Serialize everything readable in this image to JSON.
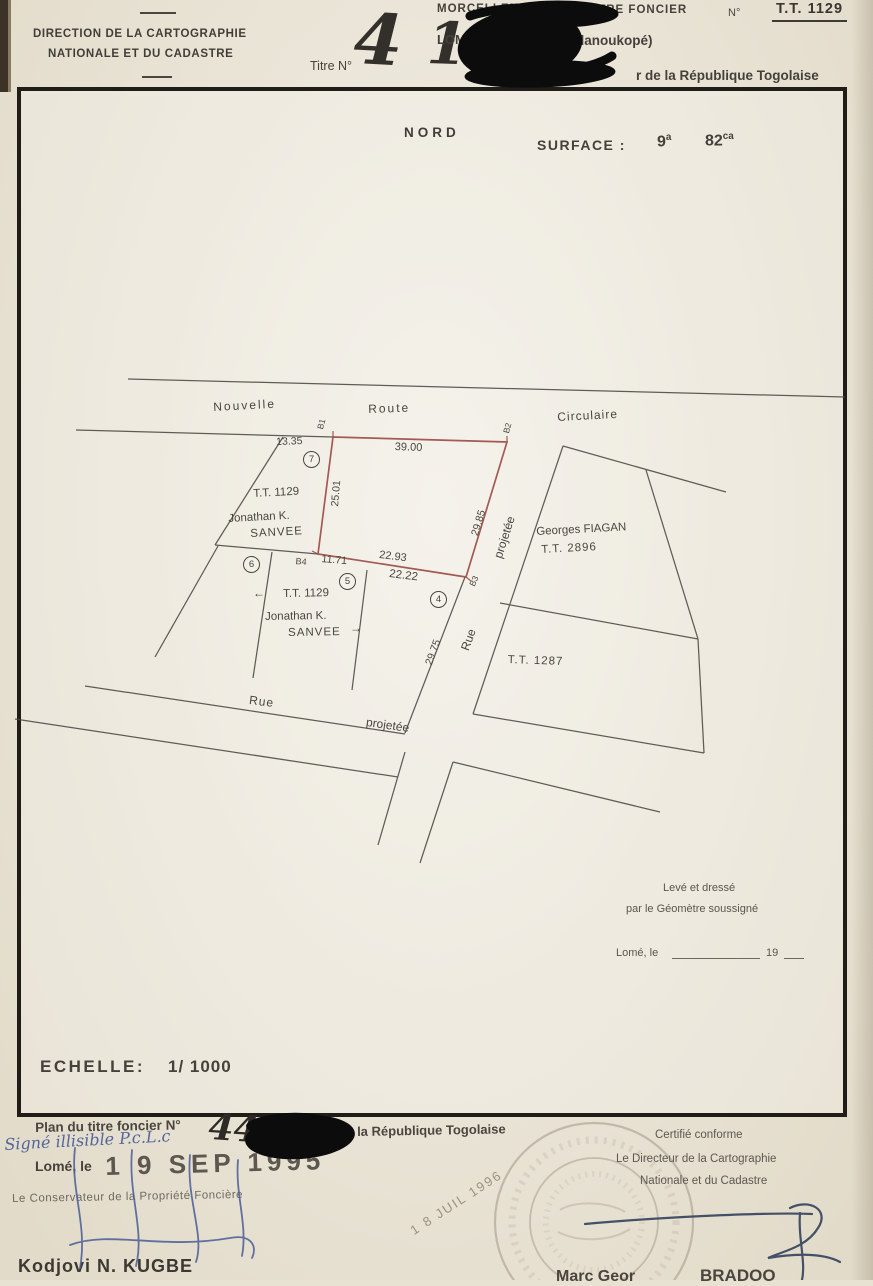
{
  "colors": {
    "paper": "#e8e2d2",
    "ink": "#4a473f",
    "parcel_red": "#9b4a44",
    "pen_blue": "#4a5c98",
    "stamp_gray": "#a79d8c"
  },
  "header": {
    "org_line1": "DIRECTION DE LA CARTOGRAPHIE",
    "org_line2": "NATIONALE ET DU CADASTRE",
    "titre_label": "Titre N°",
    "titre_handwritten_1": "4",
    "titre_handwritten_2": "1",
    "morcellement": "MORCELLEM",
    "titre_foncier": "TITRE FONCIER",
    "numero_label": "N°",
    "numero_value": "T.T. 1129",
    "ville": "LOME",
    "quartier": "danoukopé)",
    "republique": "r de la République Togolaise"
  },
  "plan_sheet": {
    "nord": "NORD",
    "surface_label": "SURFACE :",
    "surface_a": "9",
    "surface_a_unit": "a",
    "surface_ca": "82",
    "surface_ca_unit": "ca",
    "leve_line1": "Levé et dressé",
    "leve_line2": "par le Géomètre soussigné",
    "lome_le": "Lomé, le",
    "annee_prefix": "19",
    "echelle_label": "ECHELLE:",
    "echelle_value": "1/ 1000"
  },
  "map": {
    "street_top": [
      "Nouvelle",
      "Route",
      "Circulaire"
    ],
    "street_diagonal": [
      "Rue",
      "projetée"
    ],
    "street_bottom": [
      "Rue",
      "projetée"
    ],
    "points": {
      "b1": "B1",
      "b2": "B2",
      "b3": "B3",
      "b4": "B4"
    },
    "measures": {
      "left_offset": "13.35",
      "top": "39.00",
      "west": "25.01",
      "east": "29.85",
      "south_red": "22.93",
      "south": "22.22",
      "b4_segment": "11.71",
      "parcel4_side": "29.75"
    },
    "parcel7": {
      "num": "7",
      "tt": "T.T. 1129",
      "owner1": "Jonathan K.",
      "owner2": "SANVEE"
    },
    "parcel_group": {
      "num6": "6",
      "num5": "5",
      "num4": "4",
      "arrow_left": "←",
      "arrow_right": "→",
      "tt": "T.T. 1129",
      "owner1": "Jonathan K.",
      "owner2": "SANVEE"
    },
    "parcel_east": {
      "owner": "Georges FIAGAN",
      "tt": "T.T. 2896"
    },
    "parcel_southeast": {
      "tt": "T.T. 1287"
    }
  },
  "footer": {
    "plan_line_label": "Plan du titre foncier N°",
    "plan_line_number": "44",
    "plan_line_suffix": "la République Togolaise",
    "handwritten_note": "Signé illisible P.c.L.c",
    "lome_le": "Lomé, le",
    "date_stamp": "1 9 SEP 1995",
    "conservateur": "Le Conservateur de la Propriété Foncière",
    "conservateur_name": "Kodjovi N. KUGBE",
    "certifie": "Certifié conforme",
    "directeur_line1": "Le Directeur de la Cartographie",
    "directeur_line2": "Nationale et du Cadastre",
    "stamp_date": "1 8 JUIL 1996",
    "cut_name_1": "Marc Geor",
    "cut_name_2": "BRADOO"
  }
}
